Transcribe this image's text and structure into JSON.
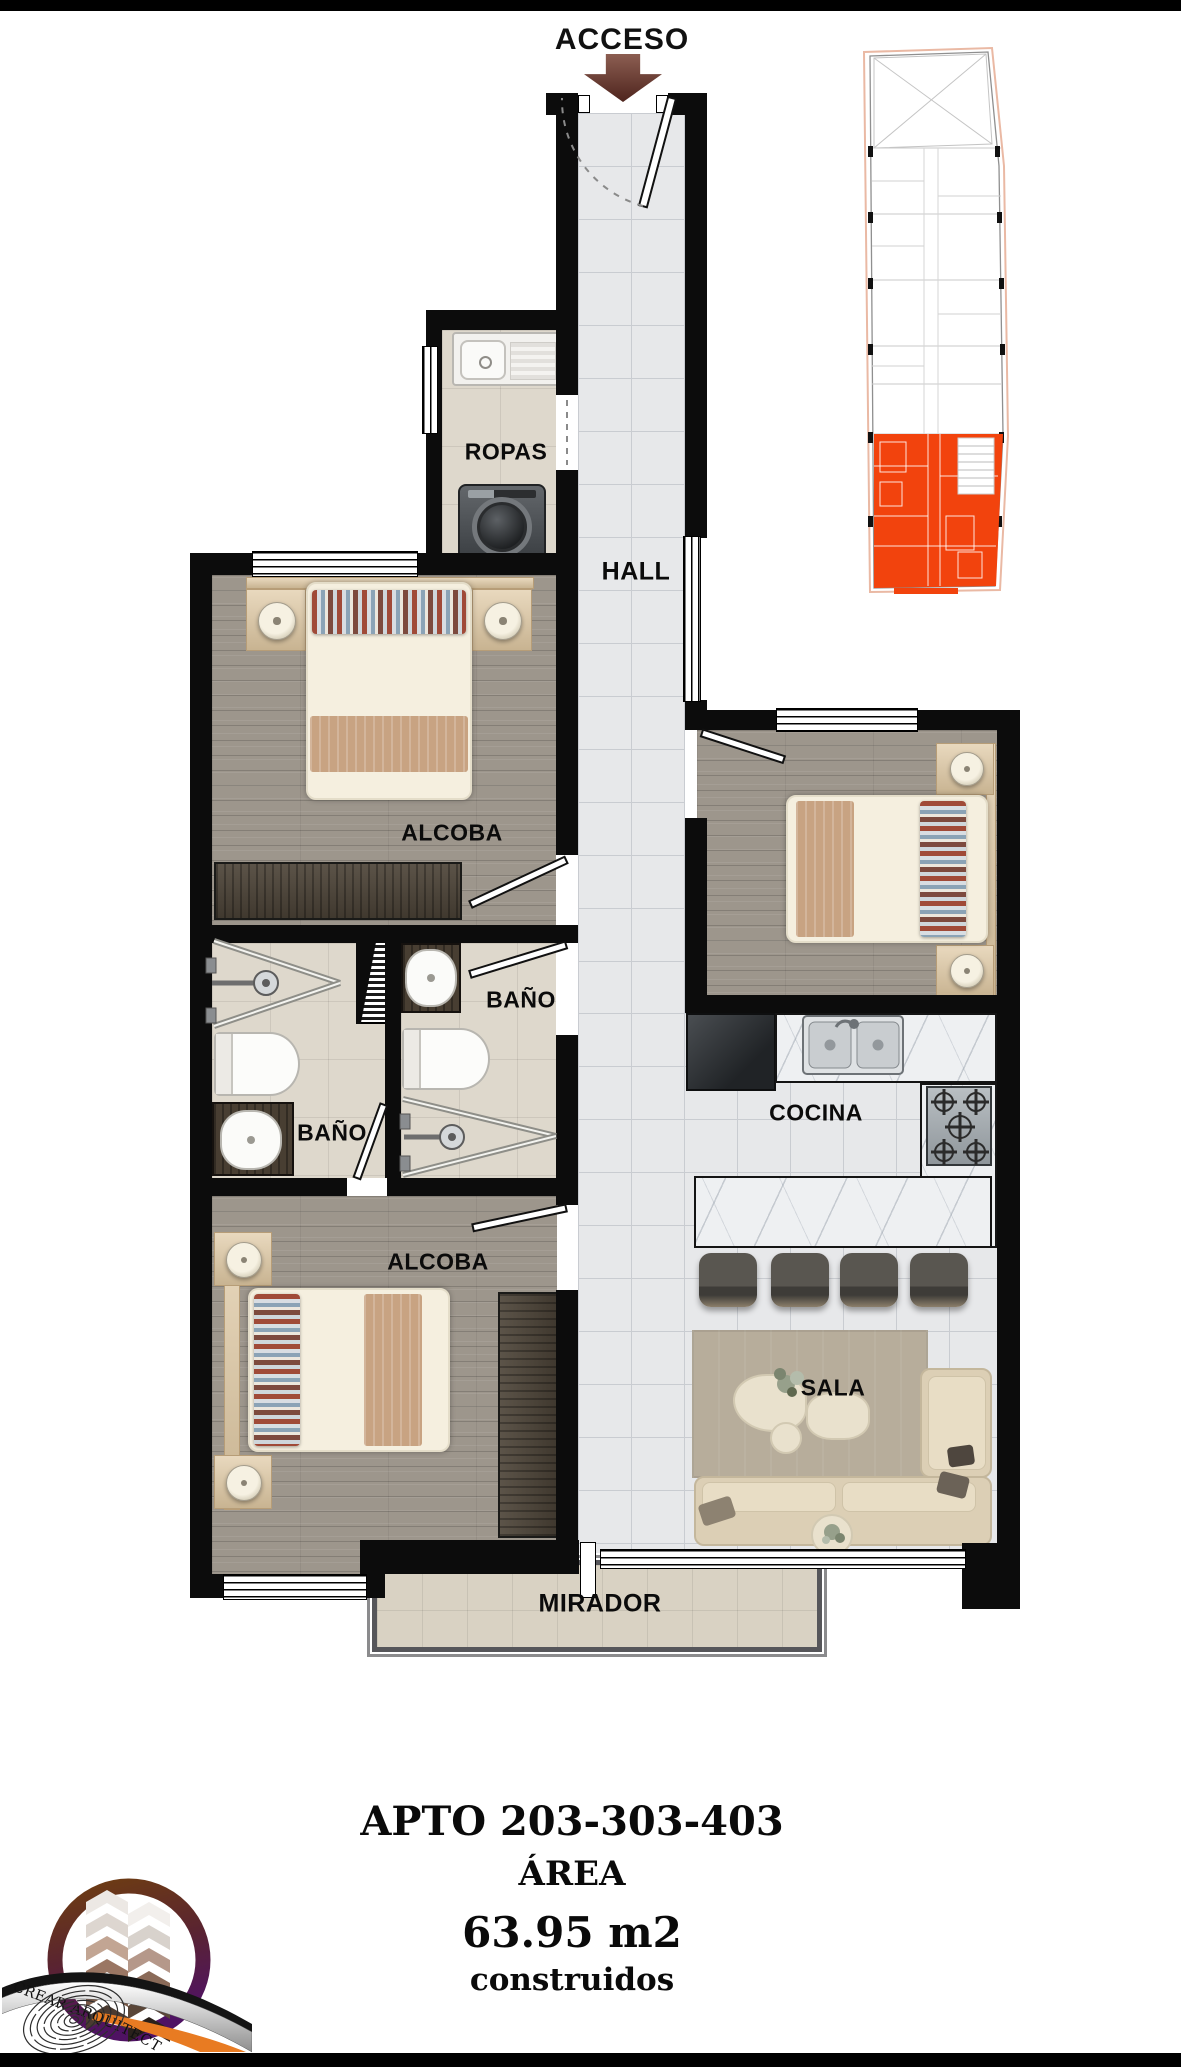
{
  "access": {
    "label": "ACCESO"
  },
  "rooms": {
    "hall": "HALL",
    "ropas": "ROPAS",
    "alcoba_top": "ALCOBA",
    "bano_hall": "BAÑO",
    "bano_interior": "BAÑO",
    "alcoba_bottom": "ALCOBA",
    "cocina": "COCINA",
    "sala": "SALA",
    "mirador": "MIRADOR"
  },
  "title_block": {
    "apartment": "APTO 203-303-403",
    "area_label": "ÁREA",
    "area_value": "63.95 m2",
    "area_note": "construidos"
  },
  "logo": {
    "text": "CREAR ARQUITECTURA"
  },
  "key_plan": {
    "highlight_color": "#f2430d"
  },
  "colors": {
    "wall": "#0c0c0c",
    "access_arrow": "#5b2d25",
    "highlight": "#f2430d"
  }
}
